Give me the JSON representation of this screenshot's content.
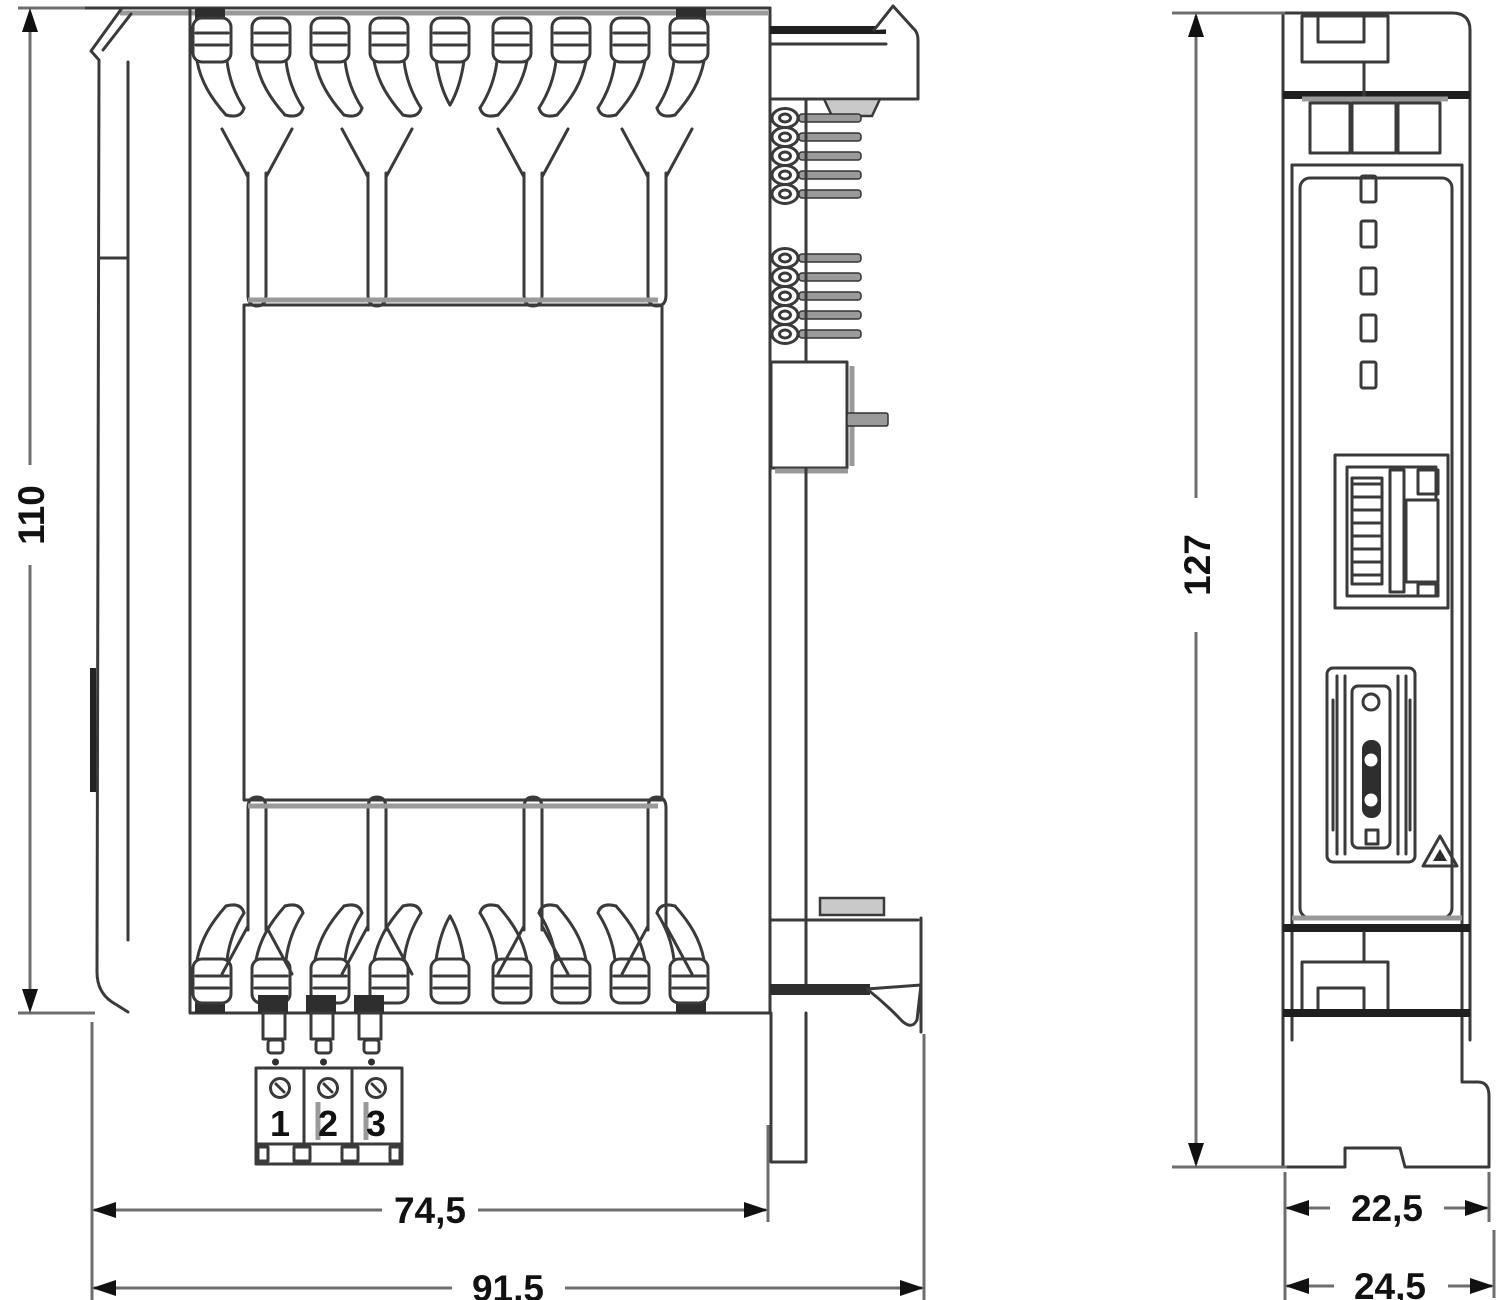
{
  "drawing": {
    "type": "technical-dimension-drawing",
    "views": {
      "side_view": "module side view with heat-sink vents, label plate, pin headers and DIN-rail clips",
      "front_view": "module front view with LEDs, ethernet port, card-slot connector and DIN-rail foot"
    },
    "dimensions": {
      "side_height_mm": "110",
      "side_body_width_mm": "74,5",
      "side_total_width_mm": "91,5",
      "front_height_mm": "127",
      "front_body_depth_mm": "22,5",
      "front_total_depth_mm": "24,5"
    },
    "terminal_block": {
      "labels": [
        "1",
        "2",
        "3"
      ]
    },
    "icons": [
      "warning-triangle-icon"
    ],
    "colors": {
      "line": "#3a3a3a",
      "line_dark": "#1f1f1f",
      "line_gray": "#9a9a9a",
      "fill_dark": "#2e2e2e",
      "background": "#ffffff",
      "text": "#111111"
    }
  }
}
